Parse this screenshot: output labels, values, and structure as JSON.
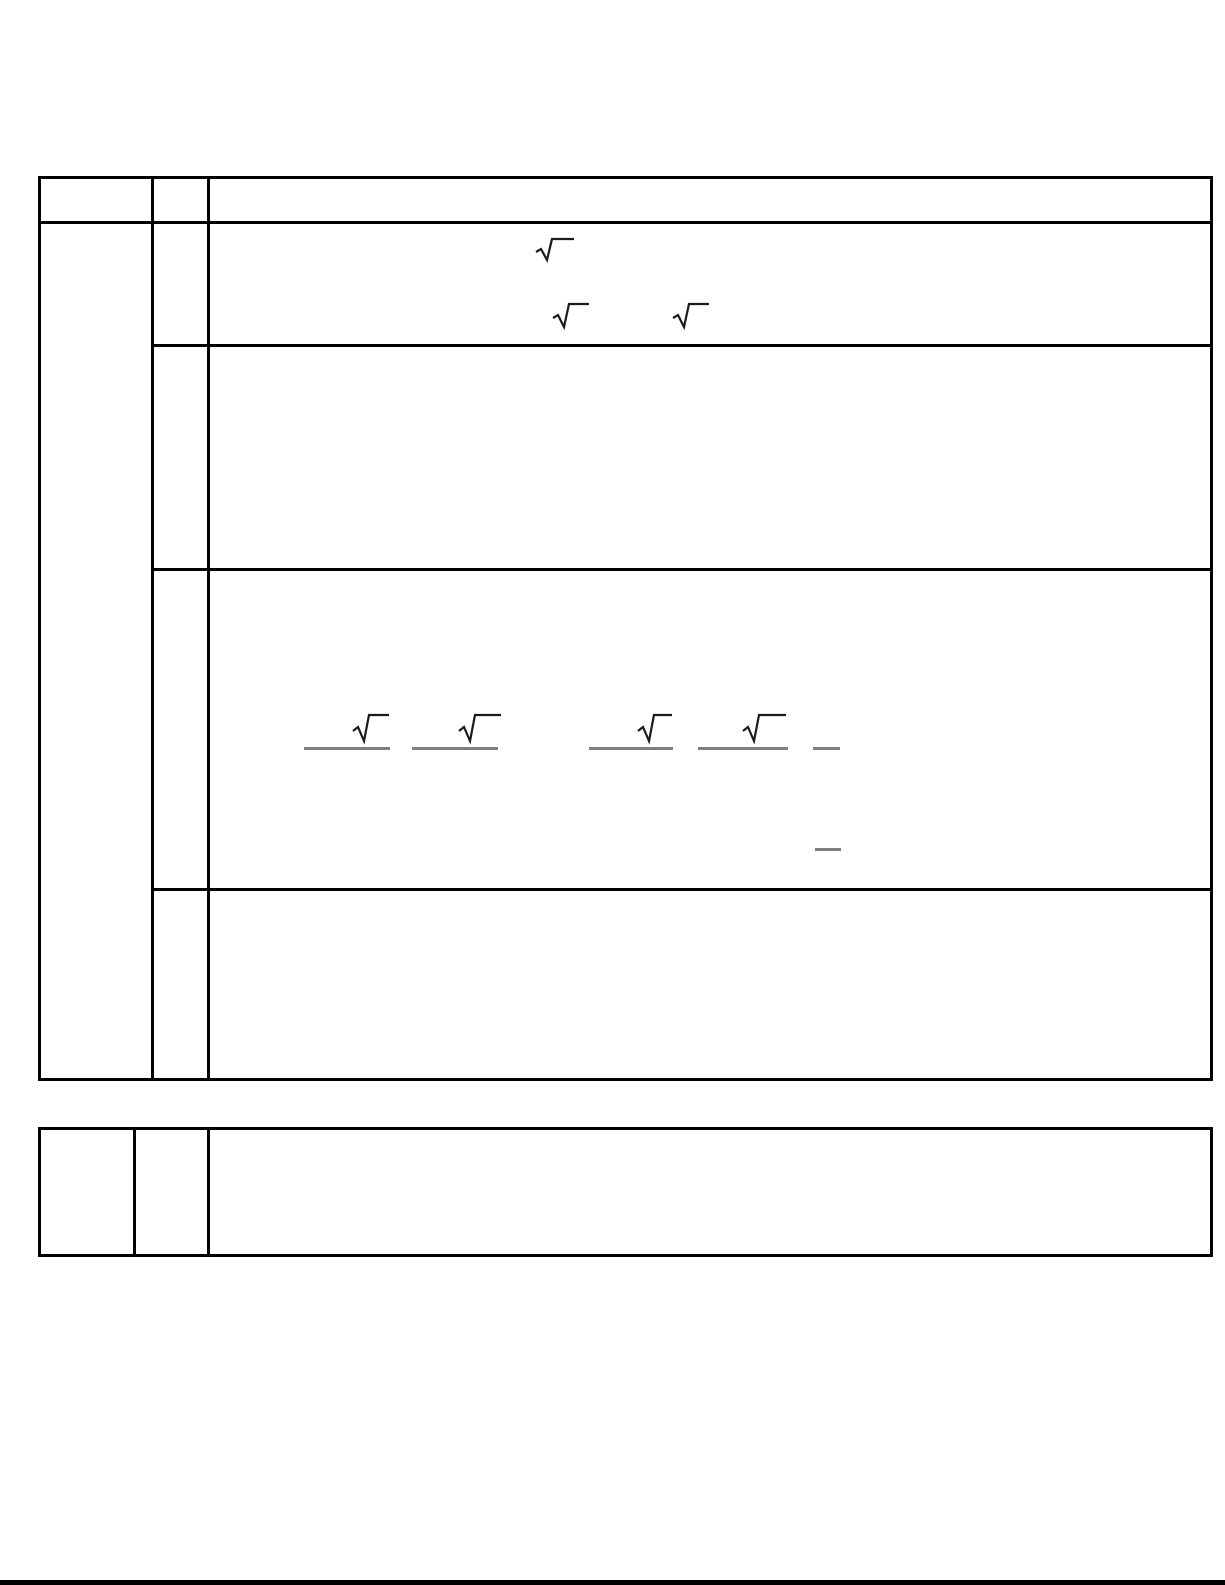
{
  "page": {
    "background_color": "#ffffff",
    "bottom_rule_color": "#000000"
  },
  "colors": {
    "table_border": "#000000",
    "radical_glyph": "#1b1b1b",
    "answer_line": "#7f7f7f"
  },
  "icons": {
    "radical": "radical-sign-icon",
    "answer_blank": "answer-underline"
  },
  "main_table": {
    "header": {
      "col1": "",
      "col2": "",
      "col3": ""
    },
    "side_cell": "",
    "rows": [
      {
        "marker": "",
        "content": "",
        "radical_count": 3
      },
      {
        "marker": "",
        "content": "",
        "radical_count": 0
      },
      {
        "marker": "",
        "content": "",
        "radical_count": 4,
        "underline_count": 5,
        "short_blank_count": 1
      },
      {
        "marker": "",
        "content": "",
        "radical_count": 0
      }
    ]
  },
  "footer_table": {
    "cells": {
      "col1": "",
      "col2": "",
      "col3": ""
    }
  }
}
